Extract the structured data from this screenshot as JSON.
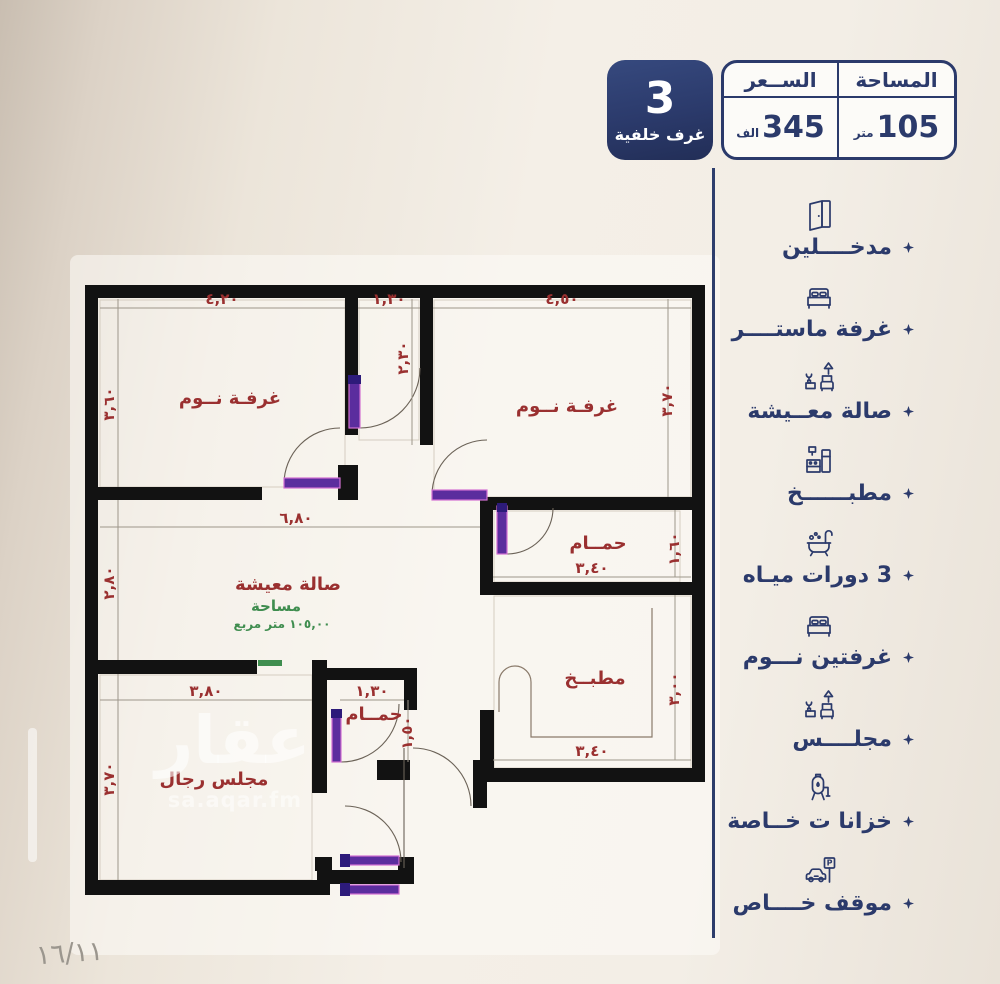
{
  "colors": {
    "navy": "#2b3a6b",
    "red": "#9a3030",
    "green": "#3f8d4f",
    "purple": "#5b2d9e",
    "wall": "#121212"
  },
  "header": {
    "badge": {
      "number": "3",
      "label": "غرف خلفية"
    },
    "price": {
      "header": "الســعر",
      "value": "345",
      "unit": "الف"
    },
    "area": {
      "header": "المساحة",
      "value": "105",
      "unit": "متر"
    }
  },
  "features": [
    {
      "icon": "door-icon",
      "label": "مدخــــلين"
    },
    {
      "icon": "bed-icon",
      "label": "غرفة ماستــــر"
    },
    {
      "icon": "sofa-icon",
      "label": "صالة معــيشة"
    },
    {
      "icon": "kitchen-icon",
      "label": "مطبــــــخ"
    },
    {
      "icon": "bathtub-icon",
      "label": "3 دورات ميـاه"
    },
    {
      "icon": "bed-icon",
      "label": "غرفتين نـــوم"
    },
    {
      "icon": "sofa-icon",
      "label": "مجلــــس"
    },
    {
      "icon": "tank-icon",
      "label": "خزانا ت خــاصة"
    },
    {
      "icon": "parking-icon",
      "label": "موقف خــــاص"
    }
  ],
  "plan": {
    "rooms": {
      "bedroom_top_left": "غرفـة نــوم",
      "bedroom_top_right": "غرفـة نــوم",
      "living": "صالة معيشة",
      "living_area_label": "مساحة",
      "living_area_value": "١٠٥,٠٠ متر مربع",
      "bathroom": "حمــام",
      "kitchen": "مطبــخ",
      "majlis": "مجلس رجال",
      "small_bathroom": "حمــام"
    },
    "dims": {
      "bed1_w": "٤,٢٠",
      "bed1_h": "٣,٦٠",
      "hall_w": "١,٣٠",
      "hall_h": "٢,٣٠",
      "bed2_w": "٤,٥٠",
      "bed2_h": "٣,٧٠",
      "living_w": "٦,٨٠",
      "living_h": "٢,٨٠",
      "bath_w": "٣,٤٠",
      "bath_h": "١,٦٠",
      "kitchen_w": "٣,٤٠",
      "kitchen_h": "٣,٠٠",
      "majlis_w": "٣,٨٠",
      "majlis_h": "٣,٧٠",
      "sbath_w": "١,٣٠",
      "sbath_h": "١,٥٠"
    },
    "watermark": {
      "logo": "عقار",
      "site": "sa.aqar.fm"
    },
    "page_number": "١٦/١١"
  },
  "icons": {
    "parking_letter": "P"
  }
}
